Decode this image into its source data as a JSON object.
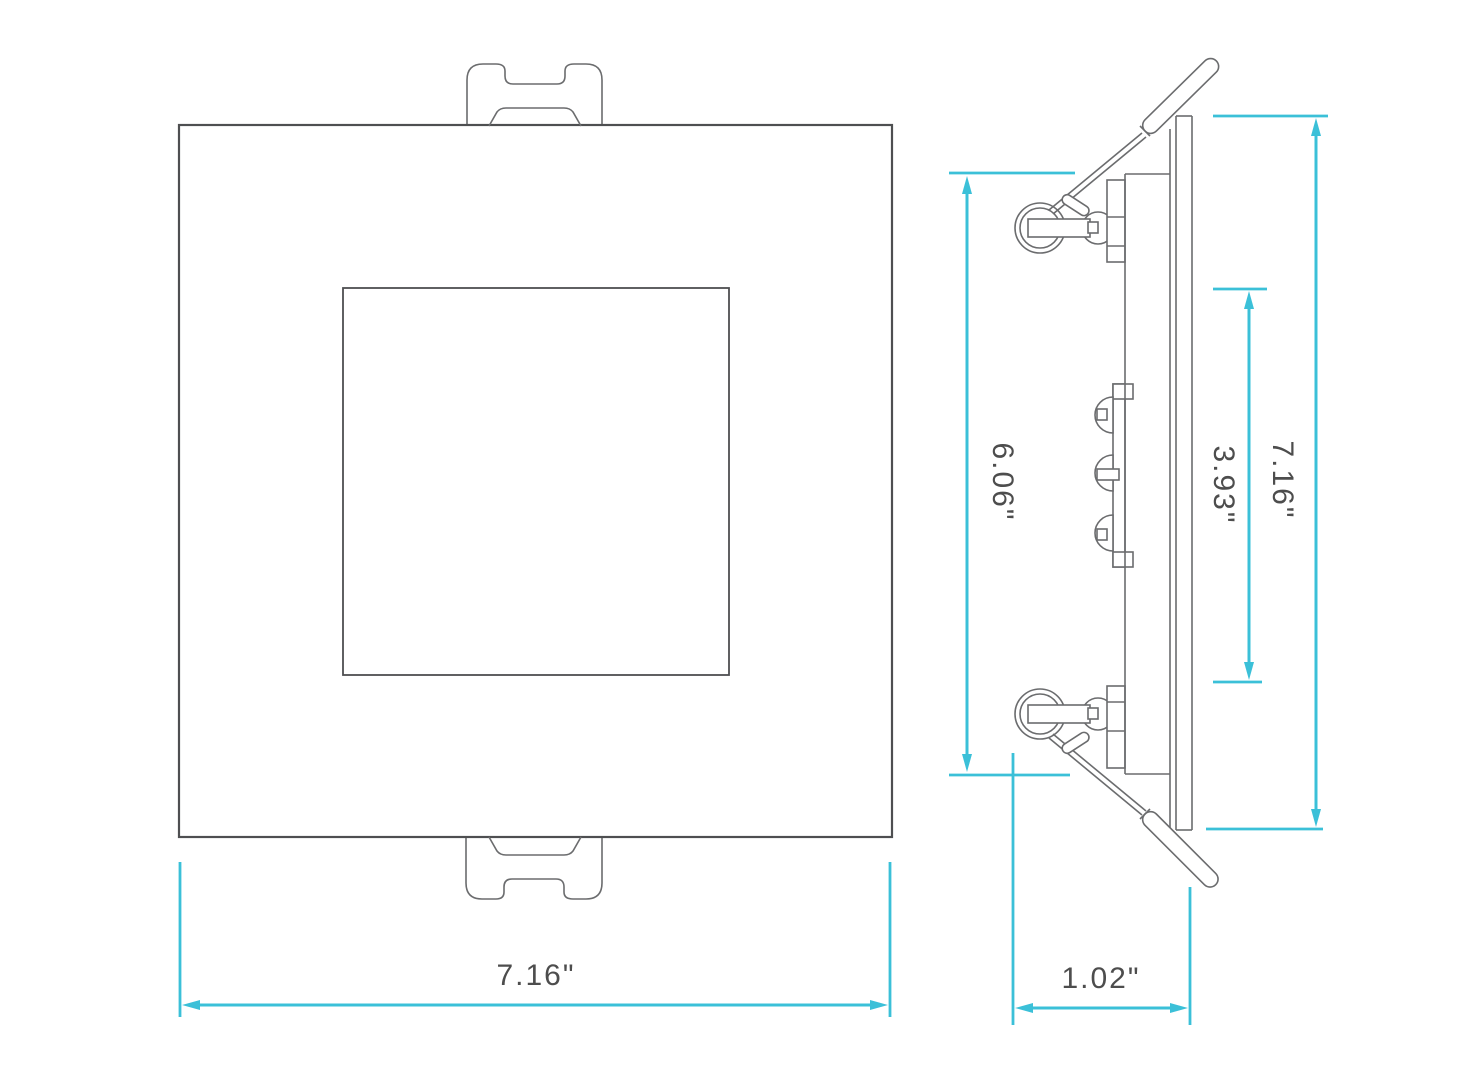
{
  "colors": {
    "dimension_accent": "#3BC0D8",
    "drawing_line": "#6B6C6E",
    "drawing_line_dark": "#4E4F51",
    "label_text": "#4D4D4D"
  },
  "front_view": {
    "width_label": "7.16\""
  },
  "side_view": {
    "housing_height_label": "6.06\"",
    "aperture_height_label": "3.93\"",
    "overall_height_label": "7.16\"",
    "recess_depth_label": "1.02\""
  }
}
